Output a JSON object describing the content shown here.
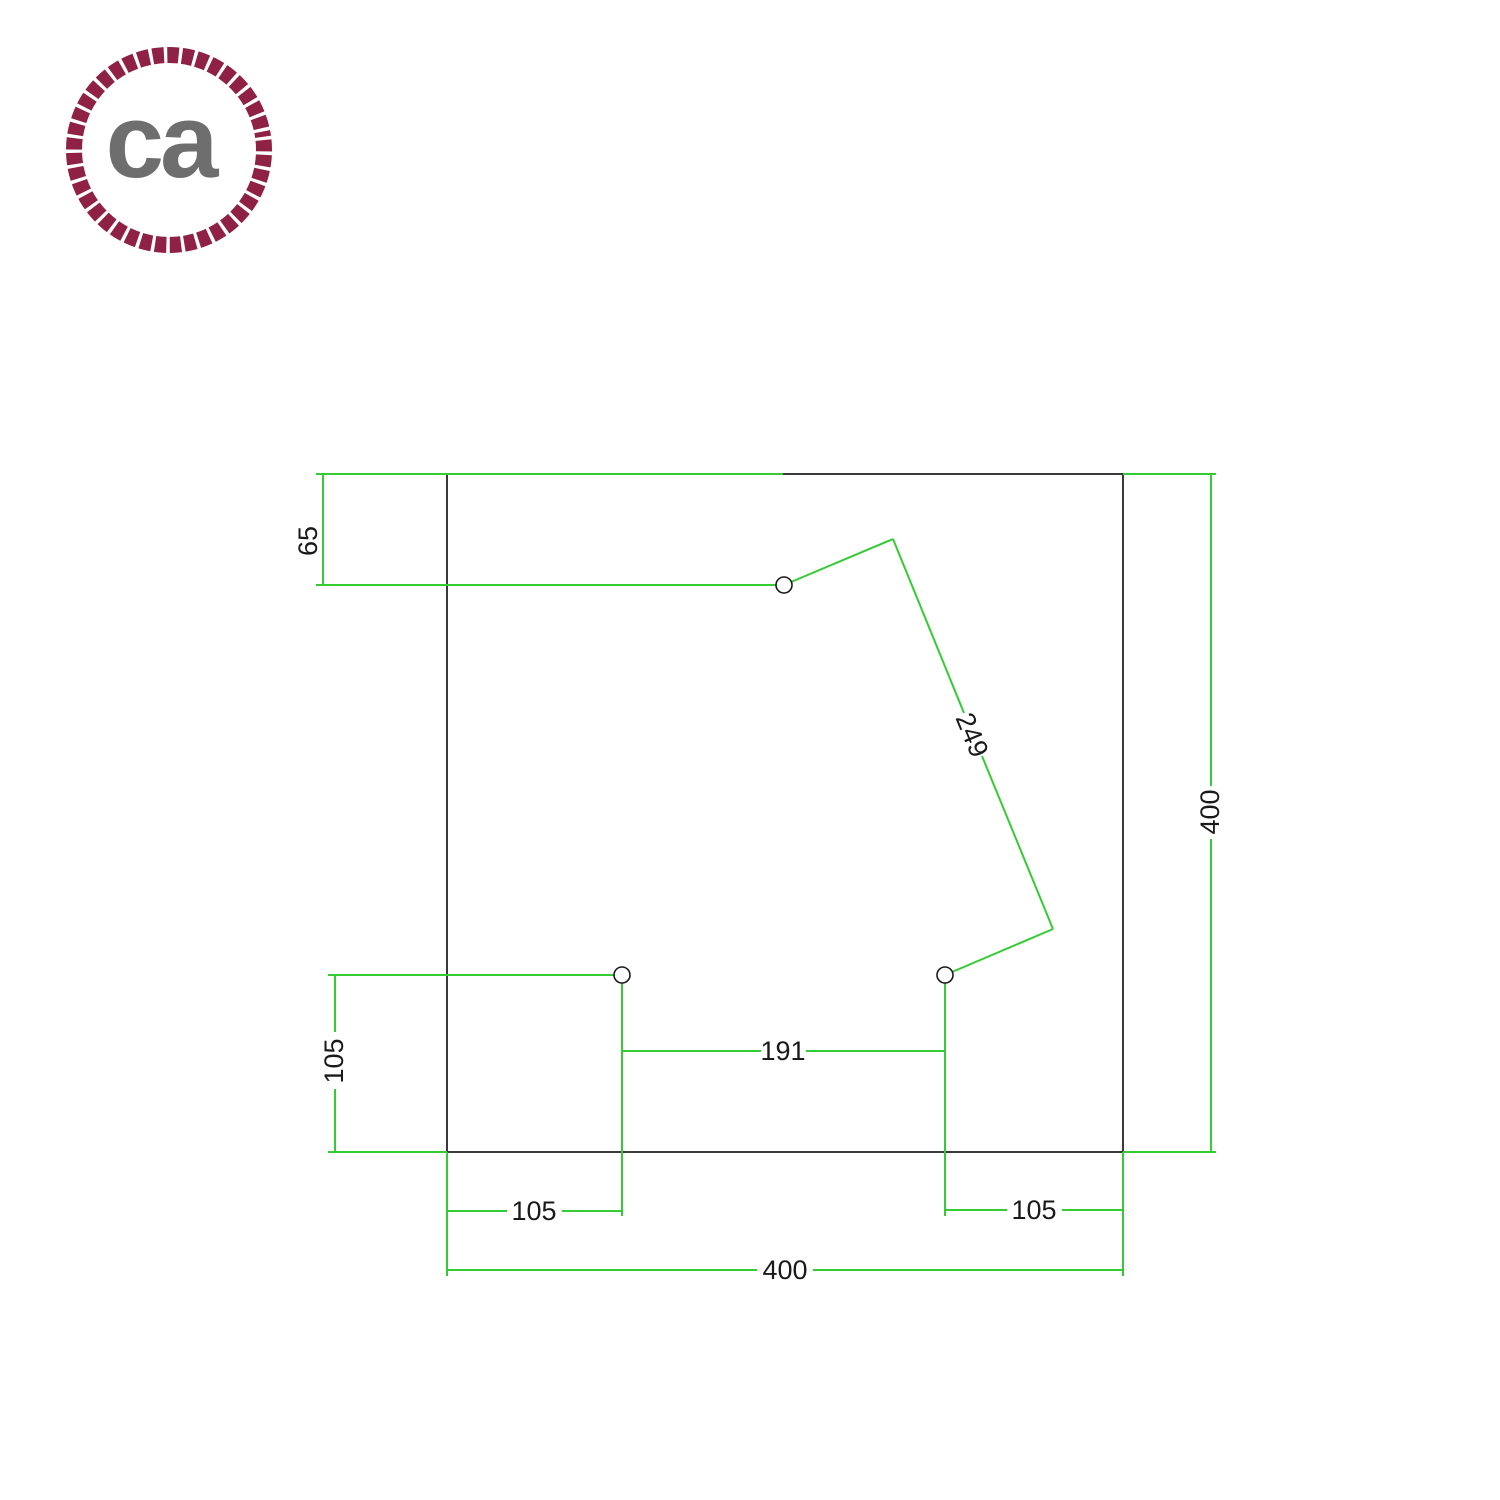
{
  "logo": {
    "monogram": "ca",
    "rope_color": "#8e2144",
    "monogram_color": "#6e6e6e"
  },
  "drawing": {
    "description": "Square ceiling rose drilling template with 3 holes, top view",
    "plate": {
      "shape": "square",
      "width_label": "400",
      "height_label": "400"
    },
    "colors": {
      "outline": "#3a3a3a",
      "dimension": "#35cb35",
      "label_text": "#1a1a1a",
      "hole_outline": "#1a1a1a",
      "hole_fill": "#ffffff"
    },
    "holes_count": 3,
    "dimensions": [
      {
        "name": "top-hole-to-top-edge",
        "label": "65"
      },
      {
        "name": "top-hole-to-bottom-right-hole",
        "label": "249"
      },
      {
        "name": "plate-height",
        "label": "400"
      },
      {
        "name": "bottom-left-hole-to-bottom-edge",
        "label": "105"
      },
      {
        "name": "bottom-holes-spacing",
        "label": "191"
      },
      {
        "name": "bottom-left-hole-to-left-edge",
        "label": "105"
      },
      {
        "name": "bottom-right-hole-to-right-edge",
        "label": "105"
      },
      {
        "name": "plate-width",
        "label": "400"
      }
    ]
  }
}
